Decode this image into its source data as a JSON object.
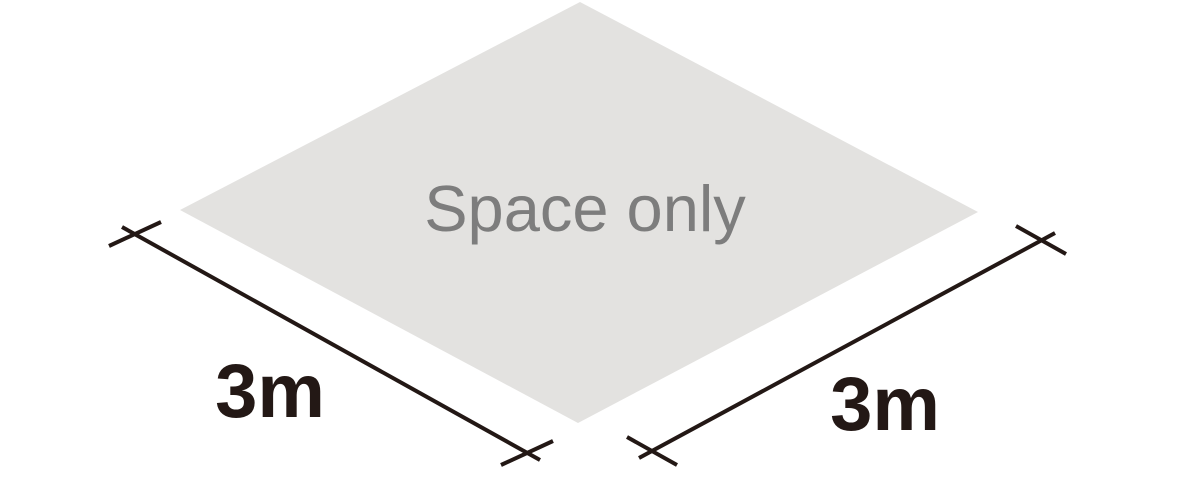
{
  "diagram": {
    "title": "isometric-space-only-booth-diagram",
    "space_label": "Space only",
    "dimensions": {
      "left": "3m",
      "right": "3m"
    },
    "colors": {
      "background": "#ffffff",
      "floor_fill": "#e3e2e0",
      "space_label_color": "#7d7d7d",
      "line_color": "#231815"
    }
  }
}
